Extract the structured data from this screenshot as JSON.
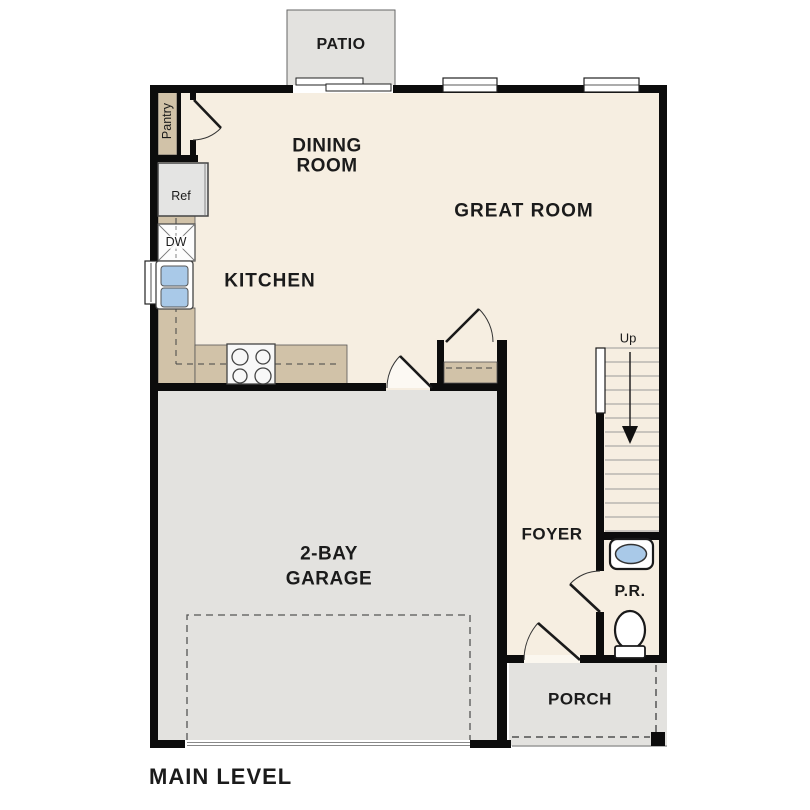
{
  "plan": {
    "title": "MAIN LEVEL",
    "rooms": {
      "patio": "PATIO",
      "dining_room": {
        "line1": "DINING",
        "line2": "ROOM"
      },
      "great_room": "GREAT ROOM",
      "kitchen": "KITCHEN",
      "garage": {
        "line1": "2-BAY",
        "line2": "GARAGE"
      },
      "foyer": "FOYER",
      "powder_room": "P.R.",
      "porch": "PORCH"
    },
    "fixtures": {
      "pantry": "Pantry",
      "refrigerator": "Ref",
      "dishwasher": "DW",
      "stairs_direction": "Up"
    },
    "colors": {
      "interior_floor": "#f6eee1",
      "exterior_floor": "#e3e2df",
      "counter": "#d1c2a8",
      "fixture_blue": "#a9c9e8",
      "wall": "#0c0c0c"
    }
  }
}
